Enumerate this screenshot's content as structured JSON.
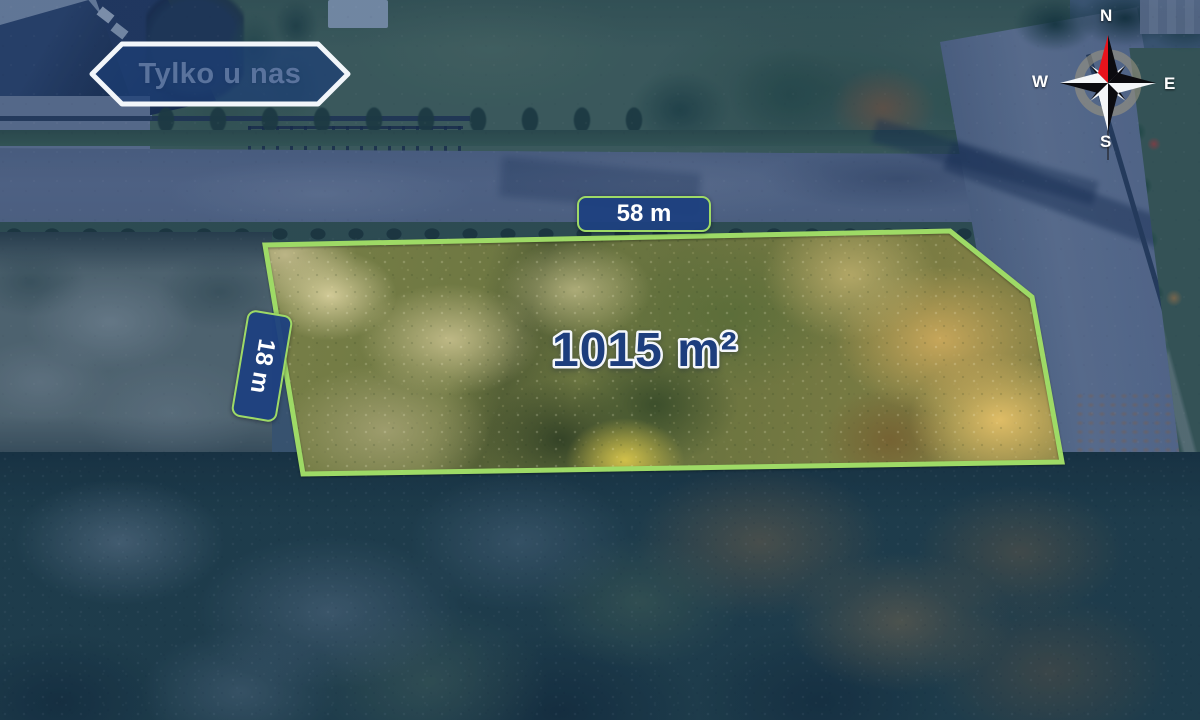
{
  "overlay": {
    "badge": {
      "label": "Tylko u nas"
    },
    "plot": {
      "area_label": "1015 m²",
      "frontage_label": "58 m",
      "depth_label": "18 m"
    },
    "compass": {
      "north": "N",
      "east": "E",
      "south": "S",
      "west": "W"
    },
    "colors": {
      "plot_outline": "#9eda66",
      "dimension_label_bg": "#1e4080",
      "dimension_label_border": "#9eda66",
      "area_text": "#1d3e7d",
      "area_text_outline": "#f4f7fb",
      "badge_fill": "rgba(28,62,118,0.7)",
      "badge_border": "#f2f6fa",
      "compass_needle": "#e8131c",
      "photo_tint_navy": "#16326e"
    }
  }
}
